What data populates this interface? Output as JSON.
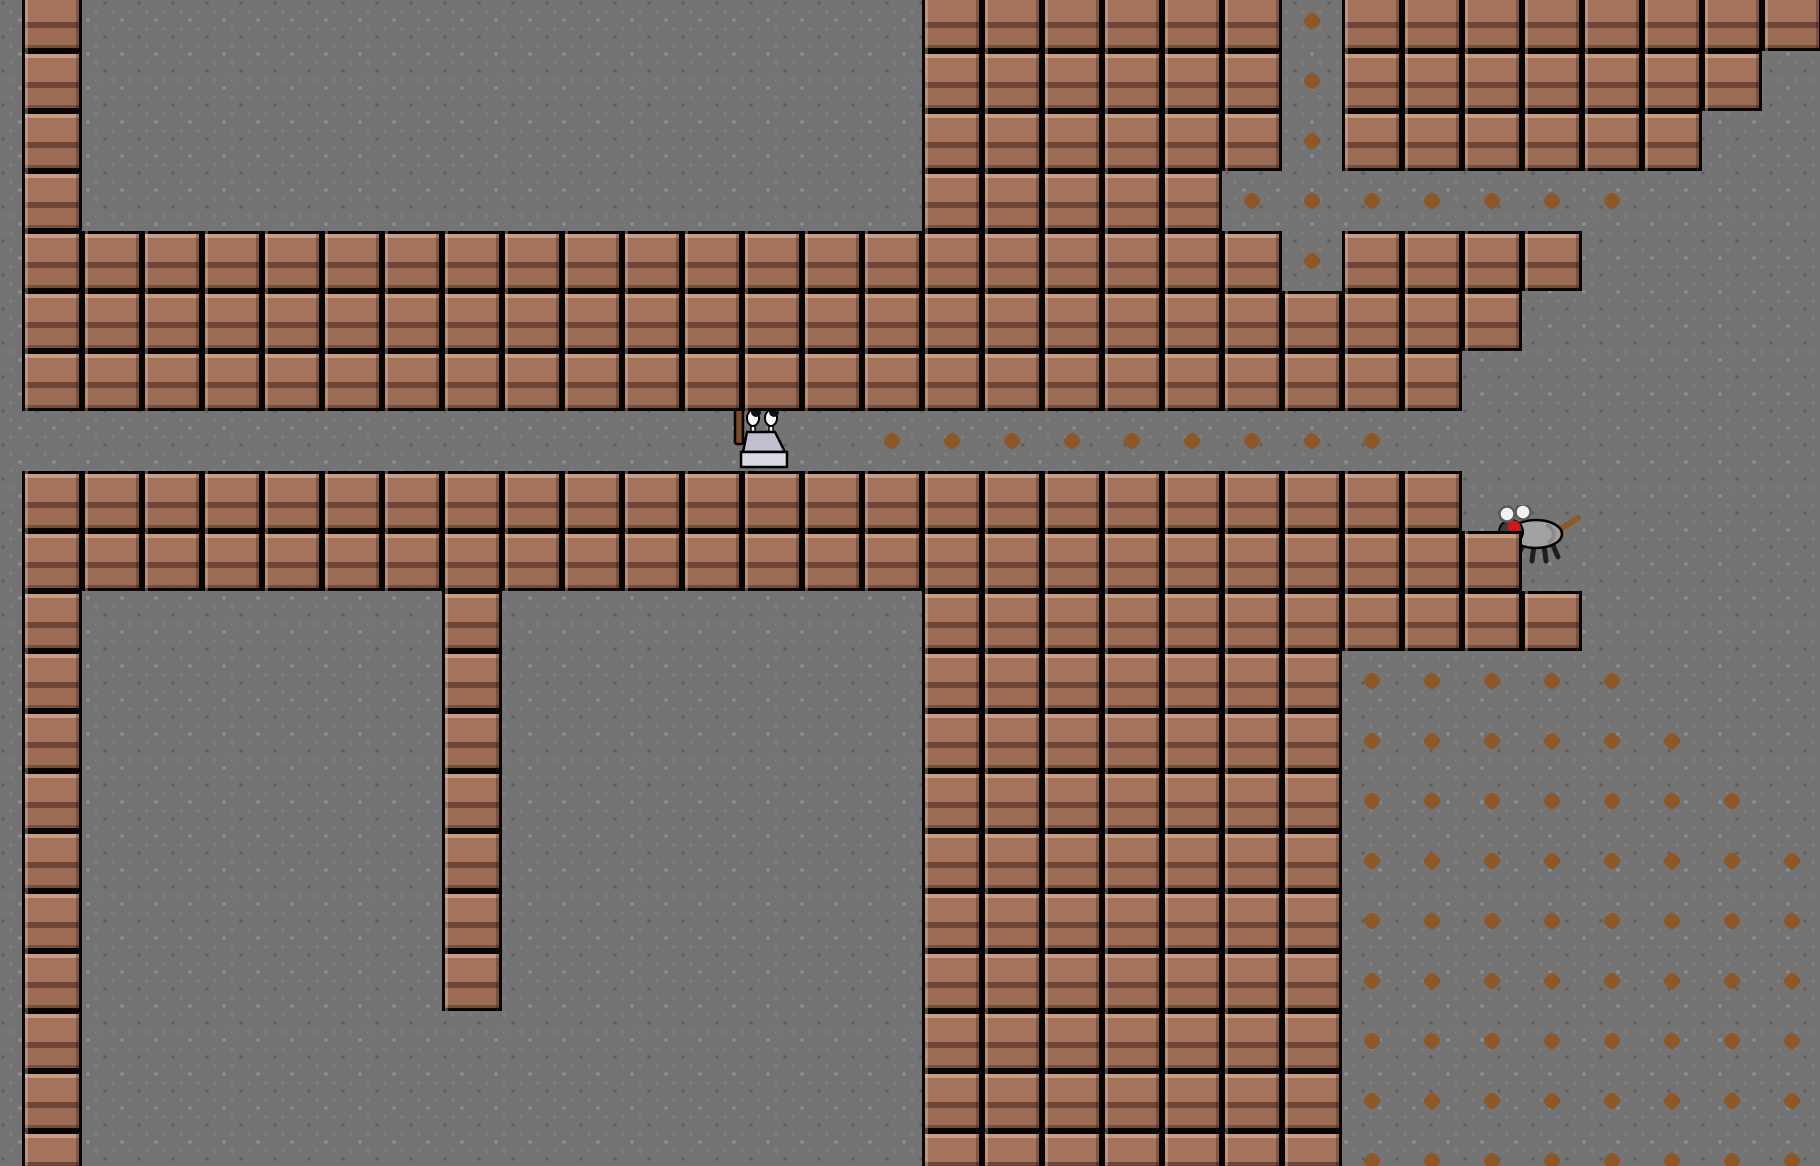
{
  "scene": {
    "name": "brick cavern level",
    "width": 1820,
    "height": 1166,
    "tile_size": 60,
    "grid_offset_x": -38,
    "grid_offset_y": -9,
    "grid_cols": 31,
    "grid_rows": 20
  },
  "colors": {
    "bg": "#747474",
    "tex-dark": "#606060",
    "tex-mid": "#7e7e7e",
    "tex-light": "#8e8e8e",
    "brick-body": "#a5735c",
    "brick-body2": "#9c6b54",
    "brick-hi": "#c99c80",
    "brick-band": "#6e4537",
    "pellet": "#8f5626",
    "player-body": "#c2bed0",
    "player-base": "#dcdae7",
    "player-eye": "#ffffff",
    "player-pupil": "#111111",
    "stick": "#7b4b28",
    "rat-body": "#a2a2a2",
    "rat-shade": "#8a8a8a",
    "rat-head": "#3c3c3c",
    "rat-eye": "#d01818",
    "rat-ear": "#f2f2f2",
    "rat-ear-line": "#5a5a5a",
    "rat-tail": "#8a5a2b",
    "rat-leg": "#1e1e1e"
  },
  "terrain": {
    "brick_rows": [
      {
        "row": 0,
        "spans": [
          [
            1,
            1
          ],
          [
            16,
            21
          ],
          [
            23,
            30
          ]
        ]
      },
      {
        "row": 1,
        "spans": [
          [
            1,
            1
          ],
          [
            16,
            21
          ],
          [
            23,
            29
          ]
        ]
      },
      {
        "row": 2,
        "spans": [
          [
            1,
            1
          ],
          [
            16,
            21
          ],
          [
            23,
            28
          ]
        ]
      },
      {
        "row": 3,
        "spans": [
          [
            1,
            1
          ],
          [
            16,
            20
          ]
        ]
      },
      {
        "row": 4,
        "spans": [
          [
            1,
            21
          ],
          [
            23,
            26
          ]
        ]
      },
      {
        "row": 5,
        "spans": [
          [
            1,
            25
          ]
        ]
      },
      {
        "row": 6,
        "spans": [
          [
            1,
            24
          ]
        ]
      },
      {
        "row": 8,
        "spans": [
          [
            1,
            24
          ]
        ]
      },
      {
        "row": 9,
        "spans": [
          [
            1,
            25
          ]
        ]
      },
      {
        "row": 10,
        "spans": [
          [
            1,
            1
          ],
          [
            8,
            8
          ],
          [
            16,
            26
          ]
        ]
      },
      {
        "row": 11,
        "spans": [
          [
            1,
            1
          ],
          [
            8,
            8
          ],
          [
            16,
            22
          ]
        ]
      },
      {
        "row": 12,
        "spans": [
          [
            1,
            1
          ],
          [
            8,
            8
          ],
          [
            16,
            22
          ]
        ]
      },
      {
        "row": 13,
        "spans": [
          [
            1,
            1
          ],
          [
            8,
            8
          ],
          [
            16,
            22
          ]
        ]
      },
      {
        "row": 14,
        "spans": [
          [
            1,
            1
          ],
          [
            8,
            8
          ],
          [
            16,
            22
          ]
        ]
      },
      {
        "row": 15,
        "spans": [
          [
            1,
            1
          ],
          [
            8,
            8
          ],
          [
            16,
            22
          ]
        ]
      },
      {
        "row": 16,
        "spans": [
          [
            1,
            1
          ],
          [
            8,
            8
          ],
          [
            16,
            22
          ]
        ]
      },
      {
        "row": 17,
        "spans": [
          [
            1,
            1
          ],
          [
            16,
            22
          ]
        ]
      },
      {
        "row": 18,
        "spans": [
          [
            1,
            1
          ],
          [
            16,
            22
          ]
        ]
      },
      {
        "row": 19,
        "spans": [
          [
            1,
            1
          ],
          [
            16,
            22
          ]
        ]
      }
    ]
  },
  "items": {
    "pellet_rows": [
      {
        "row": 0,
        "spans": [
          [
            22,
            22
          ]
        ]
      },
      {
        "row": 1,
        "spans": [
          [
            22,
            22
          ]
        ]
      },
      {
        "row": 2,
        "spans": [
          [
            22,
            22
          ]
        ]
      },
      {
        "row": 3,
        "spans": [
          [
            21,
            27
          ]
        ]
      },
      {
        "row": 4,
        "spans": [
          [
            22,
            22
          ]
        ]
      },
      {
        "row": 7,
        "spans": [
          [
            15,
            23
          ]
        ]
      },
      {
        "row": 11,
        "spans": [
          [
            23,
            27
          ]
        ]
      },
      {
        "row": 12,
        "spans": [
          [
            23,
            28
          ]
        ]
      },
      {
        "row": 13,
        "spans": [
          [
            23,
            29
          ]
        ]
      },
      {
        "row": 14,
        "spans": [
          [
            23,
            30
          ]
        ]
      },
      {
        "row": 15,
        "spans": [
          [
            23,
            30
          ]
        ]
      },
      {
        "row": 16,
        "spans": [
          [
            23,
            30
          ]
        ]
      },
      {
        "row": 17,
        "spans": [
          [
            23,
            30
          ]
        ]
      },
      {
        "row": 18,
        "spans": [
          [
            23,
            30
          ]
        ]
      },
      {
        "row": 19,
        "spans": [
          [
            23,
            30
          ]
        ]
      }
    ]
  },
  "sprites": {
    "player": {
      "name": "player",
      "x": 733,
      "y": 404,
      "w": 64,
      "h": 66,
      "cell_col": 13,
      "cell_row": 7
    },
    "rat": {
      "name": "rat",
      "x": 1494,
      "y": 505,
      "w": 88,
      "h": 62
    }
  }
}
